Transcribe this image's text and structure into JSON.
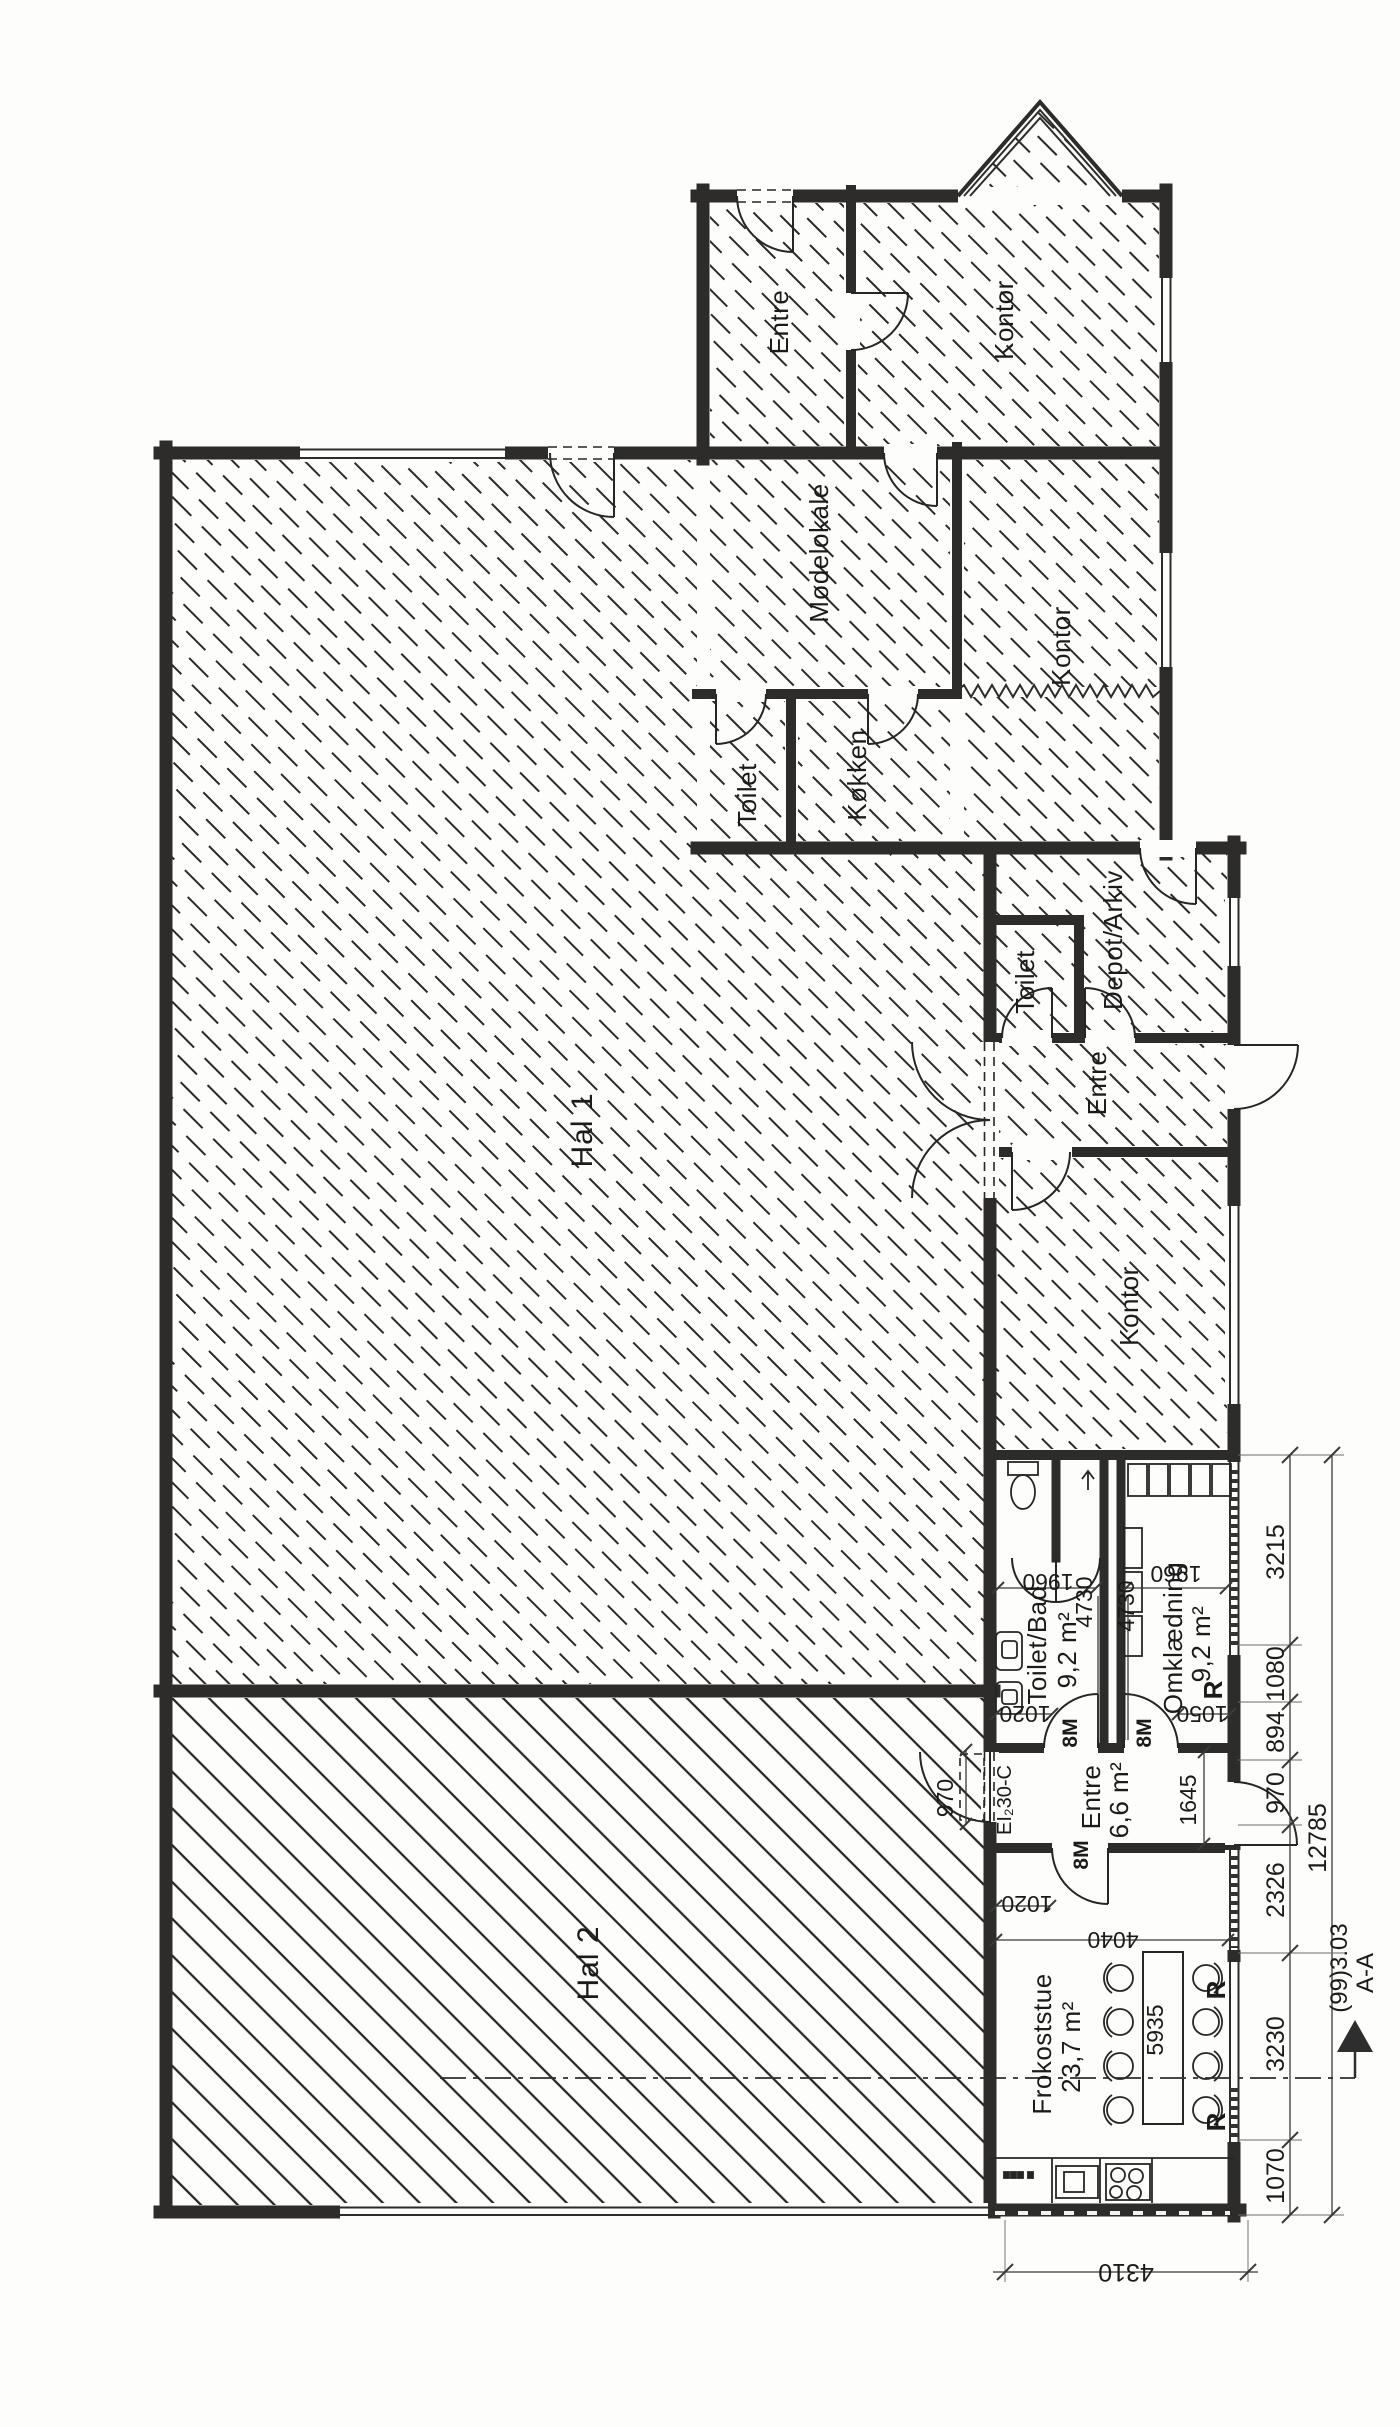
{
  "drawing_type": "floor-plan",
  "rooms": {
    "entre_top": "Entre",
    "kontor_top": "Kontor",
    "modelokale": "Mødelokale",
    "kontor_mid": "Kontor",
    "toilet_top": "Toilet",
    "kokken": "Køkken",
    "depot_arkiv": "Depot/Arkiv",
    "toilet_mid": "Toilet",
    "entre_mid": "Entre",
    "hal_1": "Hal 1",
    "kontor_south": "Kontor",
    "toilet_bad": {
      "name": "Toilet/Bad",
      "area": "9,2 m²"
    },
    "omklaedning": {
      "name": "Omklædning",
      "area": "9,2 m²"
    },
    "entre_south": {
      "name": "Entre",
      "area": "6,6 m²"
    },
    "hal_2": "Hal 2",
    "frokoststue": {
      "name": "Frokoststue",
      "area": "23,7 m²"
    }
  },
  "dims": {
    "chain": [
      "3215",
      "1080",
      "894",
      "970",
      "2326",
      "3230",
      "1070"
    ],
    "total": "12785",
    "bottom_width": "4310",
    "toiletbad_width": "1960",
    "omkl_width": "1960",
    "duct_left": "4730",
    "duct_right": "4730",
    "toiletbad_door": "1020",
    "omkl_door": "1050",
    "entre_depth": "1645",
    "hal2_door": "970",
    "frokost_door": "1020",
    "frokost_width": "4040",
    "table_length": "5935"
  },
  "doors": {
    "standard": "8M",
    "fire_rating": "EI₂30-C"
  },
  "symbols": {
    "radiator": "R"
  },
  "section": {
    "ref": "(99)3.03",
    "cut": "A-A"
  }
}
